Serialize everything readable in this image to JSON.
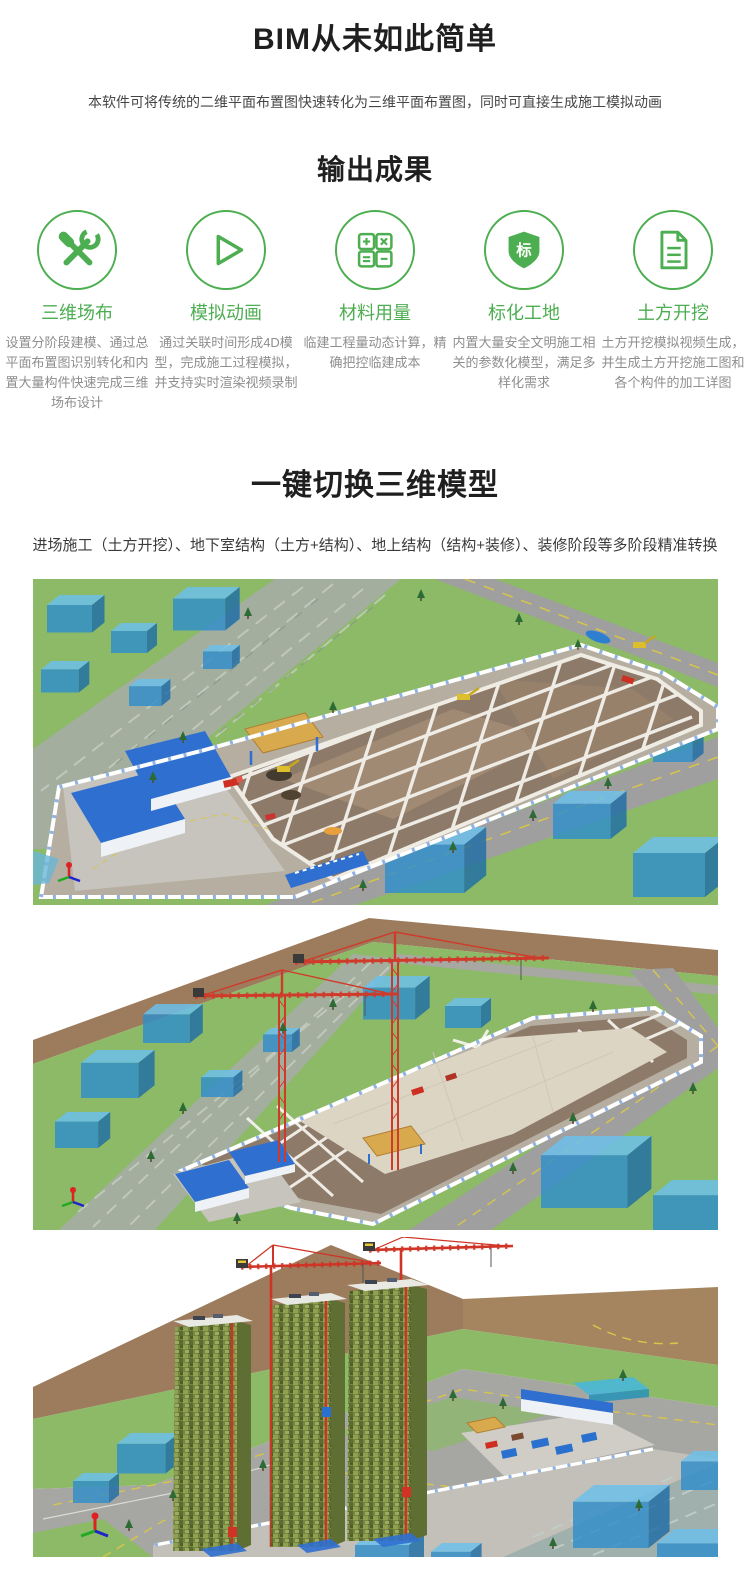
{
  "theme": {
    "accent_green": "#4cae50",
    "title_color": "#1f1f1f",
    "desc_color": "#8e8e8e"
  },
  "hero": {
    "title": "BIM从未如此简单",
    "subtitle": "本软件可将传统的二维平面布置图快速转化为三维平面布置图，同时可直接生成施工模拟动画"
  },
  "outputs": {
    "title": "输出成果",
    "items": [
      {
        "icon": "tools-icon",
        "title": "三维场布",
        "desc": "设置分阶段建模、通过总平面布置图识别转化和内置大量构件快速完成三维场布设计"
      },
      {
        "icon": "play-icon",
        "title": "模拟动画",
        "desc": "通过关联时间形成4D模型，完成施工过程模拟，并支持实时渲染视频录制"
      },
      {
        "icon": "calculator-icon",
        "title": "材料用量",
        "desc": "临建工程量动态计算，精确把控临建成本"
      },
      {
        "icon": "badge-shield-icon",
        "title": "标化工地",
        "badge_char": "标",
        "desc": "内置大量安全文明施工相关的参数化模型，满足多样化需求"
      },
      {
        "icon": "document-icon",
        "title": "土方开挖",
        "desc": "土方开挖模拟视频生成，并生成土方开挖施工图和各个构件的加工详图"
      }
    ]
  },
  "switcher": {
    "title": "一键切换三维模型",
    "subtitle": "进场施工（土方开挖）、地下室结构（土方+结构）、地上结构（结构+装修）、装修阶段等多阶段精准转换",
    "renders": [
      {
        "label": "进场施工（土方开挖）阶段三维渲染图"
      },
      {
        "label": "地下室结构（土方+结构）阶段三维渲染图"
      },
      {
        "label": "地上结构（结构+装修）阶段三维渲染图"
      }
    ]
  }
}
